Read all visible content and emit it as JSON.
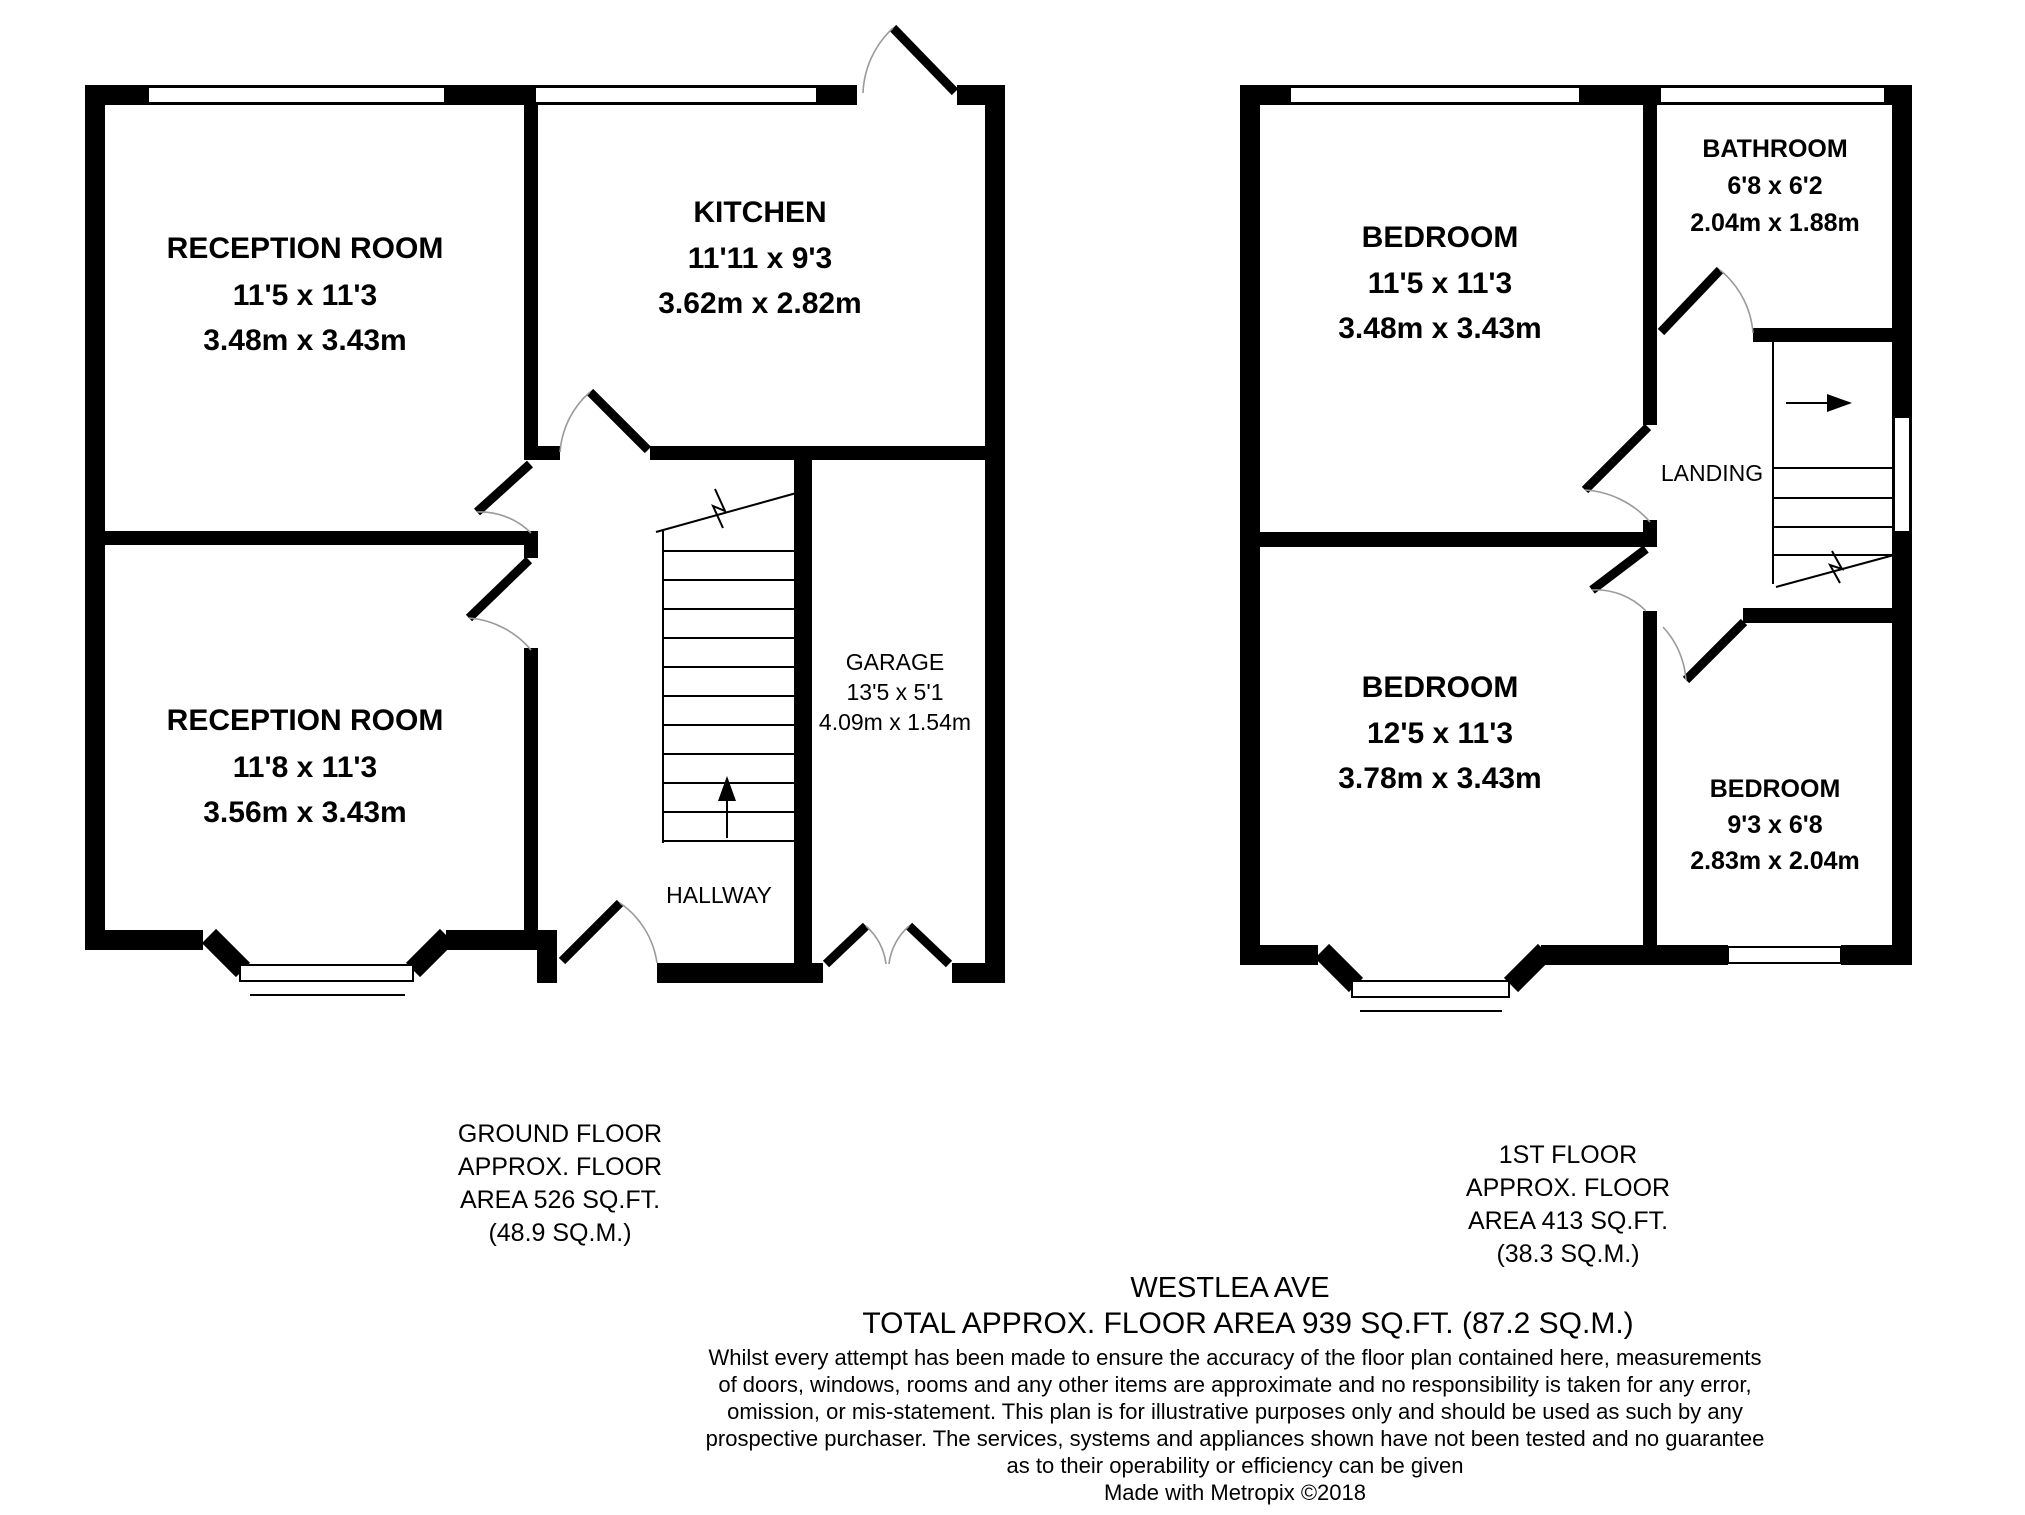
{
  "header": {
    "address": "WESTLEA AVE",
    "total_area": "TOTAL APPROX. FLOOR AREA 939 SQ.FT. (87.2 SQ.M.)",
    "credit": "Made with Metropix ©2018"
  },
  "ground_floor": {
    "caption": [
      "GROUND FLOOR",
      "APPROX. FLOOR",
      "AREA 526 SQ.FT.",
      "(48.9 SQ.M.)"
    ],
    "rooms": {
      "reception_1": {
        "name": "RECEPTION ROOM",
        "imperial": "11'5 x 11'3",
        "metric": "3.48m x 3.43m"
      },
      "kitchen": {
        "name": "KITCHEN",
        "imperial": "11'11 x 9'3",
        "metric": "3.62m x 2.82m"
      },
      "reception_2": {
        "name": "RECEPTION ROOM",
        "imperial": "11'8 x 11'3",
        "metric": "3.56m x 3.43m"
      },
      "garage": {
        "name": "GARAGE",
        "imperial": "13'5 x 5'1",
        "metric": "4.09m x 1.54m"
      },
      "hallway": {
        "name": "HALLWAY"
      }
    }
  },
  "first_floor": {
    "caption": [
      "1ST FLOOR",
      "APPROX. FLOOR",
      "AREA 413 SQ.FT.",
      "(38.3 SQ.M.)"
    ],
    "rooms": {
      "bedroom_1": {
        "name": "BEDROOM",
        "imperial": "11'5 x 11'3",
        "metric": "3.48m x 3.43m"
      },
      "bathroom": {
        "name": "BATHROOM",
        "imperial": "6'8 x 6'2",
        "metric": "2.04m x 1.88m"
      },
      "landing": {
        "name": "LANDING"
      },
      "bedroom_2": {
        "name": "BEDROOM",
        "imperial": "12'5 x 11'3",
        "metric": "3.78m x 3.43m"
      },
      "bedroom_3": {
        "name": "BEDROOM",
        "imperial": "9'3 x 6'8",
        "metric": "2.83m x 2.04m"
      }
    }
  },
  "disclaimer": [
    "Whilst every attempt has been made to ensure the accuracy of the floor plan contained here, measurements",
    "of doors, windows, rooms and any other items are approximate and no responsibility is taken for any error,",
    "omission, or mis-statement. This plan is for illustrative purposes only and should be used as such by any",
    "prospective purchaser. The services, systems and appliances shown have not been tested and no guarantee",
    "as to their operability or efficiency can be given"
  ]
}
